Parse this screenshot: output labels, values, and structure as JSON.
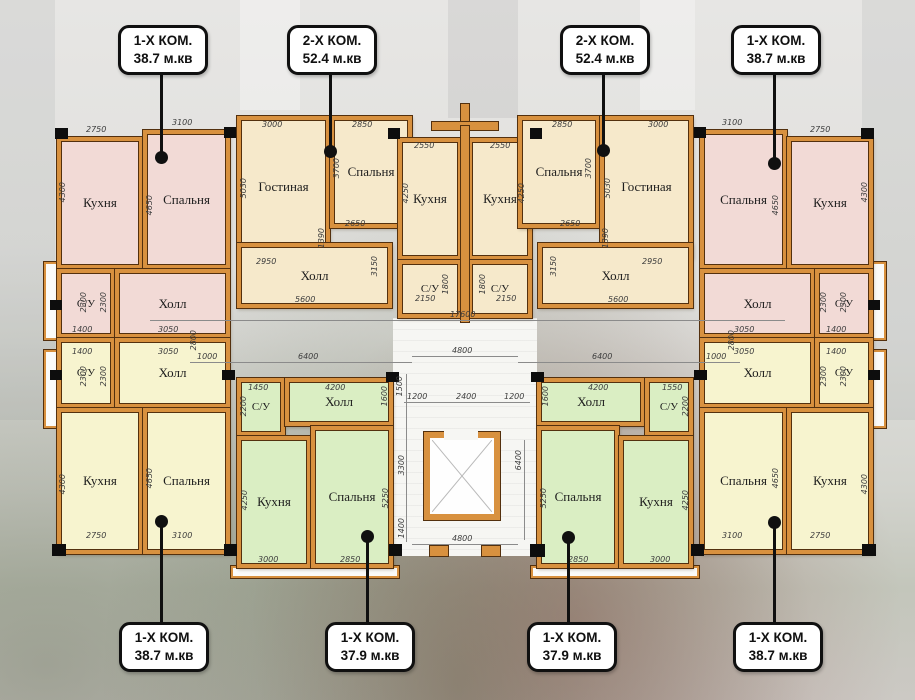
{
  "callouts": {
    "top": [
      {
        "line1": "1-Х КОМ.",
        "line2": "38.7 м.кв"
      },
      {
        "line1": "2-Х КОМ.",
        "line2": "52.4 м.кв"
      },
      {
        "line1": "2-Х КОМ.",
        "line2": "52.4 м.кв"
      },
      {
        "line1": "1-Х КОМ.",
        "line2": "38.7 м.кв"
      }
    ],
    "bottom": [
      {
        "line1": "1-Х КОМ.",
        "line2": "38.7 м.кв"
      },
      {
        "line1": "1-Х КОМ.",
        "line2": "37.9 м.кв"
      },
      {
        "line1": "1-Х КОМ.",
        "line2": "37.9 м.кв"
      },
      {
        "line1": "1-Х КОМ.",
        "line2": "38.7 м.кв"
      }
    ]
  },
  "room_labels": {
    "kitchen": "Кухня",
    "bedroom": "Спальня",
    "living_room": "Гостиная",
    "hall": "Холл",
    "bathroom": "С/У"
  },
  "dims": {
    "1000": "1000",
    "1200": "1200",
    "1390": "1390",
    "1400": "1400",
    "1450": "1450",
    "1500": "1500",
    "1550": "1550",
    "1600": "1600",
    "1800": "1800",
    "2150": "2150",
    "2200": "2200",
    "2300": "2300",
    "2400": "2400",
    "2550": "2550",
    "2650": "2650",
    "2750": "2750",
    "2800": "2800",
    "2850": "2850",
    "2950": "2950",
    "3000": "3000",
    "3050": "3050",
    "3100": "3100",
    "3150": "3150",
    "3300": "3300",
    "3700": "3700",
    "4200": "4200",
    "4250": "4250",
    "4300": "4300",
    "4650": "4650",
    "4800": "4800",
    "5030": "5030",
    "5250": "5250",
    "5600": "5600",
    "6400": "6400",
    "17600": "17600"
  },
  "colors": {
    "wall": "#d8913f",
    "wall_outline": "#53300e",
    "room_pink": "#f2dad6",
    "room_beige": "#f6e9cb",
    "room_yellow": "#f7f4cf",
    "room_green": "#daeec3",
    "callout_border": "#101010",
    "column_black": "#0d0d0d"
  }
}
